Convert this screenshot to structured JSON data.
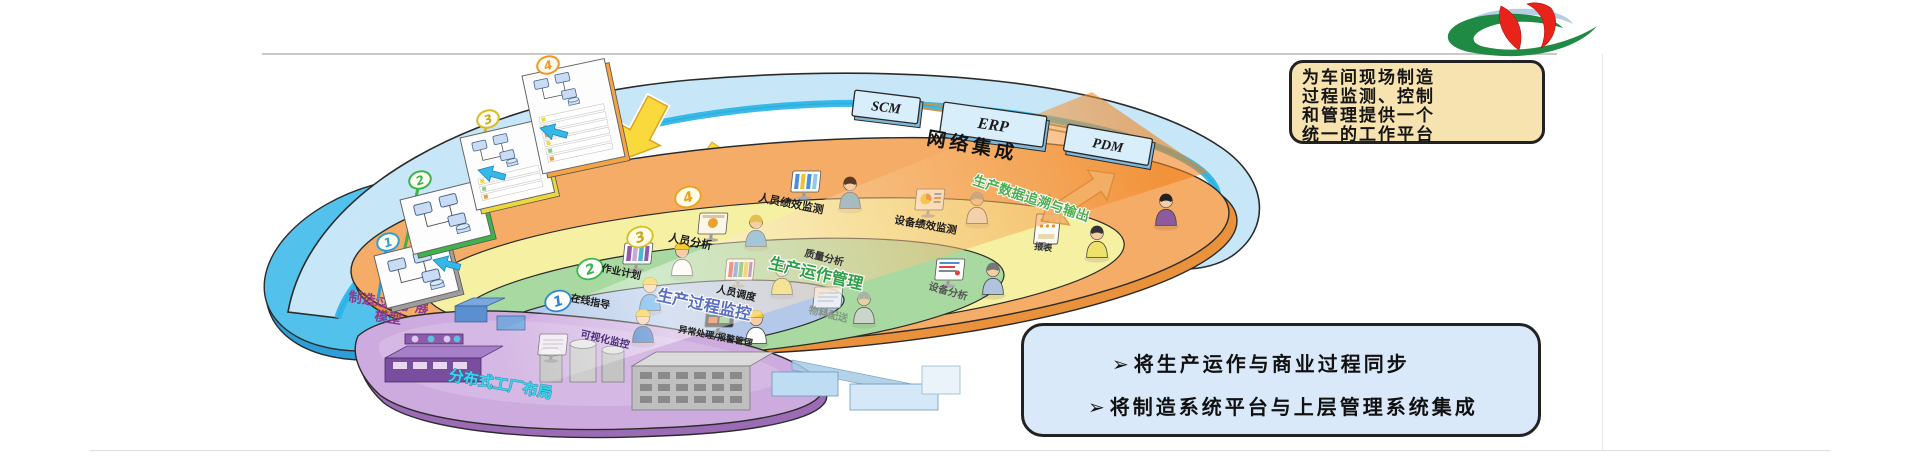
{
  "top_callout": {
    "lines": [
      "为车间现场制造",
      "过程监测、控制",
      "和管理提供一个",
      "统一的工作平台"
    ]
  },
  "bottom_callout": {
    "bullet": "➢",
    "items": [
      "将生产运作与商业过程同步",
      "将制造系统平台与上层管理系统集成"
    ]
  },
  "integration": {
    "band_label": "网络集成",
    "systems": [
      "SCM",
      "ERP",
      "PDM"
    ]
  },
  "model_panels": {
    "caption_line1": "制造过程扩展",
    "caption_line2": "模型",
    "badges": [
      "1",
      "2",
      "3",
      "4"
    ]
  },
  "rings": [
    {
      "badge": "4",
      "labels": {
        "left": "人员绩效监测",
        "mid": "设备绩效监测"
      },
      "diag_label": "生产数据追溯与输出",
      "small_label": "报表"
    },
    {
      "badge": "3",
      "labels": {
        "left": "人员分析",
        "mid": "质量分析",
        "right": "设备分析"
      }
    },
    {
      "badge": "2",
      "title": "生产运作管理",
      "labels": {
        "left": "作业计划",
        "mid": "人员调度",
        "right": "物料配送"
      }
    },
    {
      "badge": "1",
      "title": "生产过程监控",
      "labels": {
        "left": "在线指导",
        "mid": "可视化监控",
        "right": "异常处理/报警管理"
      }
    }
  ],
  "factory_layer": {
    "label": "分布式工厂布局"
  },
  "colors": {
    "network_band": "#C7E7F8",
    "network_edge": "#2EB6E8",
    "performance_ring": "#F5AC66",
    "analysis_ring": "#F6F0A2",
    "operation_ring": "#A8D9A0",
    "monitoring_ring": "#B4C9E9",
    "factory_layer": "#CDABDE",
    "model_area": "#52C2EC",
    "callout_tan": "#F7E3B0",
    "callout_blue": "#D9E9F9",
    "logo_green": "#1E8A44",
    "logo_red": "#E8231A",
    "badge_1": "#2E9FD6",
    "badge_2": "#3BB54A",
    "badge_3": "#D8BC20",
    "badge_4": "#F7941D"
  }
}
